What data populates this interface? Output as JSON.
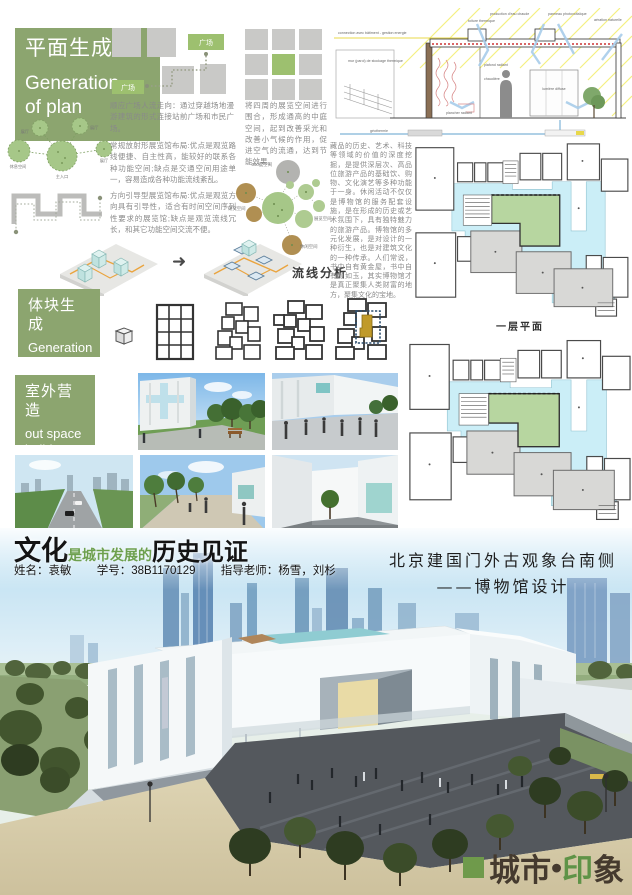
{
  "sections": {
    "plan": {
      "zh": "平面生成",
      "en1": "Generation",
      "en2": "of plan"
    },
    "body": {
      "zh": "体块生成",
      "en1": "Generation",
      "en2": "of  body"
    },
    "outspace": {
      "zh": "室外营造",
      "en1": "out space",
      "en2": "build"
    }
  },
  "labels": {
    "plaza_top": "广场",
    "plaza_bottom": "广场",
    "radial_hall_1": "展厅",
    "radial_hall_2": "展厅",
    "radial_hall_3": "展厅",
    "radial_rest": "休息空间",
    "radial_entry": "主入口",
    "bubble_360": "360度空间",
    "bubble_research": "研究空间",
    "bubble_exhibit": "展览空间",
    "bubble_leisure": "休闲空间",
    "flow": "流线分析",
    "plan_caption": "一层平面"
  },
  "paragraphs": {
    "p1": "顺应广场人流走向：通过穿越场地漫游建筑的形式连接站前广场和市民广场。",
    "p2": "常规放射形展览馆布局:优点是观览路线便捷、自主性高，能较好的联系各种功能空间;缺点是交通空间用途单一，容易造成各种功能流线紊乱。",
    "p3": "方向引导型展览馆布局:优点是观览方向具有引导性，适合有时间空间序列性要求的展览馆;缺点是观览流线冗长，和其它功能空间交流不便。",
    "p4": "将四周的展览空间进行围合，形成通高的中庭空间，起到改善采光和改善小气候的作用，促进空气的流通，达到节能效果。",
    "p5": "藏品的历史、艺术、科技等领域的价值的深度挖掘，是提供深层次、高品位旅游产品的基础饮、购物、文化演艺等多种功能于一身。休闲活动不仅仅是博物馆的服务配套设施，是在形成的历史或艺术氛围下，具有独特魅力的旅游产品。博物馆的多元化发展，是对设计的一种衍生，也是对建筑文化的一种传承。人们常说，书中自有黄金屋，书中自有颜如玉，其实博物馆才是真正聚集人类财富的地方，聚集文化的宝地。"
  },
  "section_drawing": {
    "l1": "connection avec bâtiment - gestion energie",
    "l2": "mur (paroi) de stockage thermique",
    "l3": "toiture thermique",
    "l4": "production d'eau chaude",
    "l5": "panneau photovoltaïque",
    "l6": "aération naturelle",
    "l7": "plafond radiant",
    "l8": "lumière diffuse",
    "l9": "plancher radiant",
    "l10": "chaudière",
    "l11": "géothermie"
  },
  "footer": {
    "title_1": "文化",
    "title_2": "是城市发展的",
    "title_3": "历史见证",
    "name_label": "姓名：袁敏",
    "id_label": "学号：38B1170129",
    "tutor_label": "指导老师：杨雪，刘杉",
    "project_line1": "北京建国门外古观象台南侧",
    "project_line2": "——博物馆设计",
    "logo_city": "城市",
    "logo_dot": "•",
    "logo_yin": "印",
    "logo_xiang": "象"
  },
  "colors": {
    "header_green": "#8CA56F",
    "diagram_green": "#9dc06f",
    "diagram_grey": "#c9c9c7",
    "plan_cyan": "#cbeef7",
    "plan_courtyard_green": "#b7d6a0",
    "accent_green": "#6DA04E",
    "logo_green": "#5F9347"
  }
}
